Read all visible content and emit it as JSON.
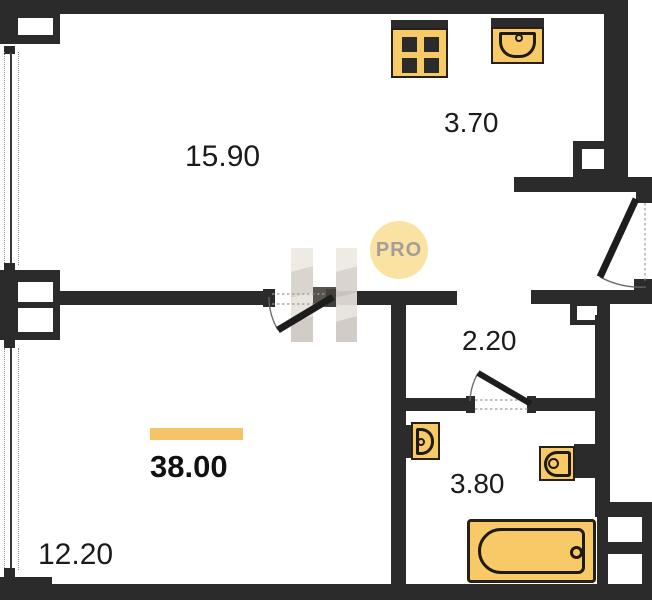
{
  "floorplan": {
    "watermark": {
      "badge_text": "PRO"
    },
    "total": {
      "area": "38.00"
    },
    "rooms": [
      {
        "name": "living-room",
        "area": "15.90"
      },
      {
        "name": "kitchen",
        "area": "3.70"
      },
      {
        "name": "hallway",
        "area": "2.20"
      },
      {
        "name": "bathroom",
        "area": "3.80"
      },
      {
        "name": "bedroom",
        "area": "12.20"
      }
    ],
    "fixtures": [
      {
        "name": "stove"
      },
      {
        "name": "kitchen-sink"
      },
      {
        "name": "wash-basin"
      },
      {
        "name": "toilet"
      },
      {
        "name": "bathtub"
      }
    ],
    "colors": {
      "wall": "#2B2B2B",
      "fixture_fill": "#F8C967",
      "fixture_outline": "#231C12",
      "badge_fill": "#FAE3A2",
      "badge_text": "#A49E96",
      "area_bar": "#F5C466",
      "label_text": "#1B1B1B"
    }
  }
}
